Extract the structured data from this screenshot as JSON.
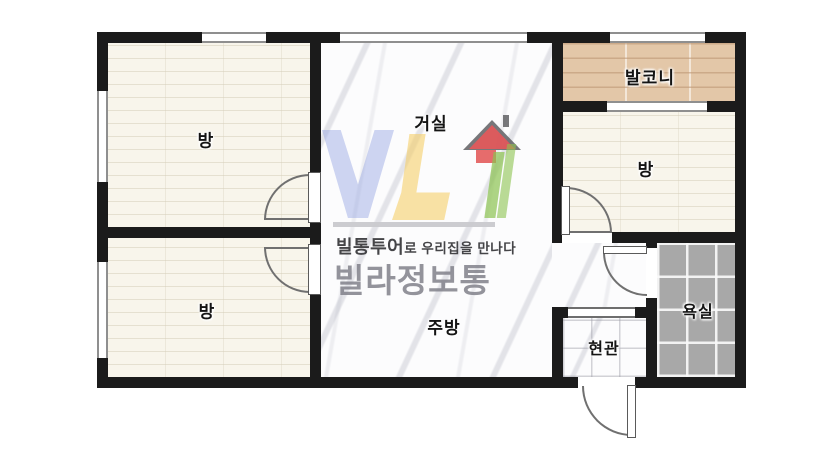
{
  "plan": {
    "type": "apartment-floor-plan",
    "rooms": [
      {
        "id": "living",
        "label": "거실"
      },
      {
        "id": "kitchen",
        "label": "주방"
      },
      {
        "id": "room-top-left",
        "label": "방"
      },
      {
        "id": "room-bottom-left",
        "label": "방"
      },
      {
        "id": "room-right",
        "label": "방"
      },
      {
        "id": "balcony",
        "label": "발코니"
      },
      {
        "id": "bathroom",
        "label": "욕실"
      },
      {
        "id": "entrance",
        "label": "현관"
      }
    ]
  },
  "watermark": {
    "tagline_bold": "빌통투어",
    "tagline_rest": "로 우리집을 만나다",
    "brand": "빌라정보통"
  },
  "colors": {
    "wall": "#1b1b1b",
    "floor_room": "#f8f5eb",
    "floor_marble": "#fcfcfd",
    "floor_balcony": "#e3c7a8",
    "floor_bathroom": "#a8a8a8",
    "logo_blue": "#8c9ee1",
    "logo_yellow": "#f4cd64",
    "logo_red": "#e45a5c",
    "logo_green": "#8cc350",
    "brand_text_gray": "#80808a"
  }
}
